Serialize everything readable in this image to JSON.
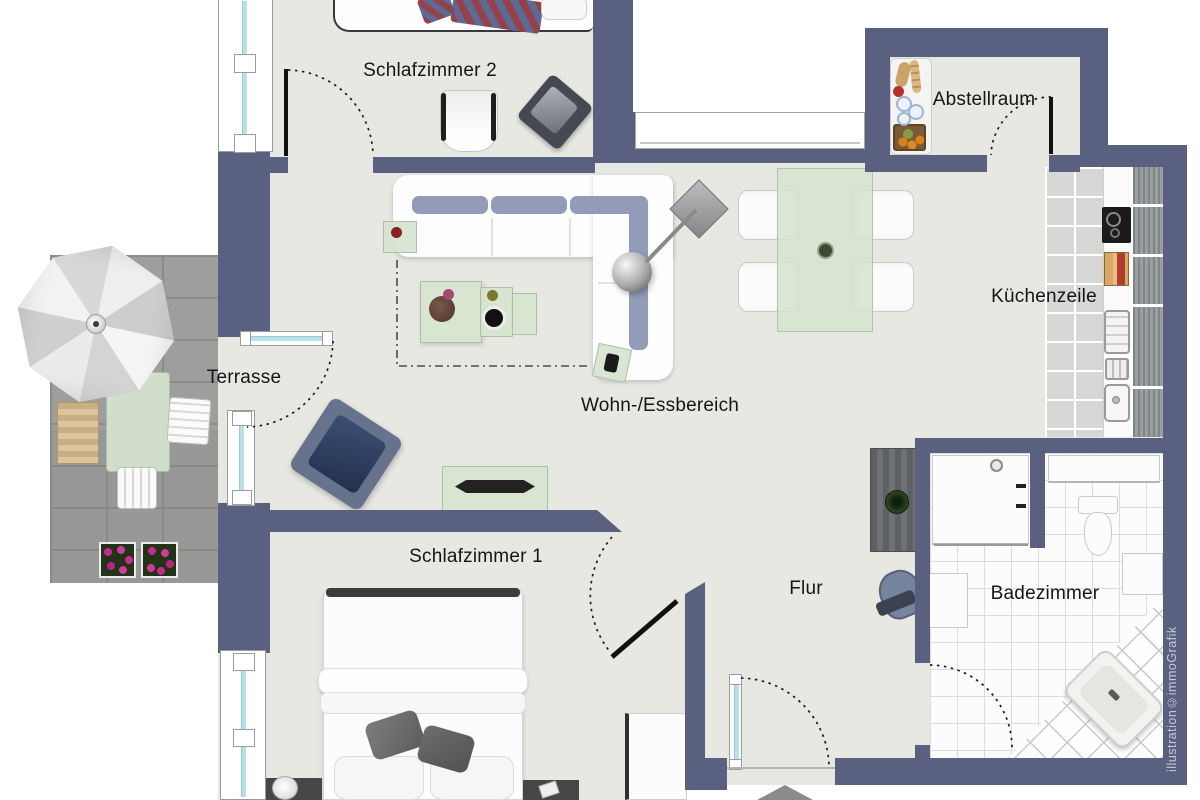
{
  "plan_title": "apartment floor plan",
  "rooms": [
    {
      "id": "schlafzimmer2",
      "label": "Schlafzimmer 2"
    },
    {
      "id": "abstellraum",
      "label": "Abstellraum"
    },
    {
      "id": "kuechenzeile",
      "label": "Küchenzeile"
    },
    {
      "id": "terrasse",
      "label": "Terrasse"
    },
    {
      "id": "wohn-essbereich",
      "label": "Wohn-/Essbereich"
    },
    {
      "id": "schlafzimmer1",
      "label": "Schlafzimmer 1"
    },
    {
      "id": "flur",
      "label": "Flur"
    },
    {
      "id": "badezimmer",
      "label": "Badezimmer"
    }
  ],
  "watermark": "illustration©immoGrafik",
  "colors": {
    "wall": "#5a6180",
    "floor": "#e8e8e3",
    "terrace_paving": "#9e9e9c",
    "window_glazing": "#b9e0e8",
    "sofa_cushion": "#929cb8",
    "furniture_green": "#d5e4cf",
    "flower": "#c42b90"
  }
}
